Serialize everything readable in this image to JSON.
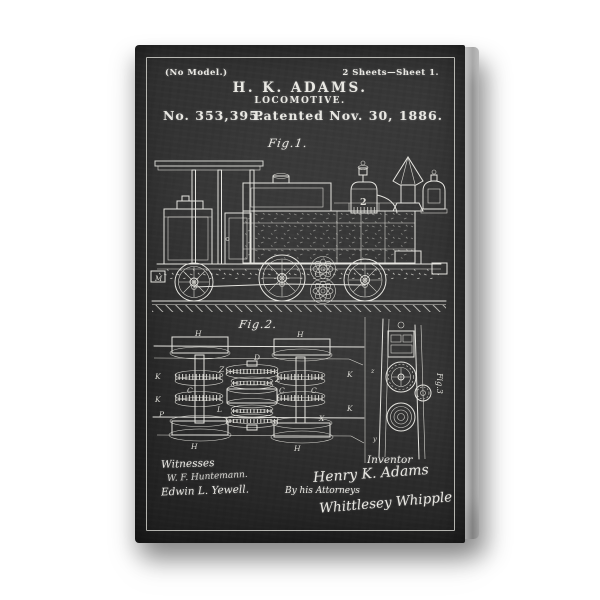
{
  "poster": {
    "background_color": "#ffffff",
    "board_color": "#2d2d2d",
    "chalk_color": "#e9e8e3"
  },
  "header": {
    "no_model": "(No Model.)",
    "sheets_note": "2 Sheets—Sheet 1.",
    "inventor_line": "H. K. ADAMS.",
    "title_line": "LOCOMOTIVE.",
    "patent_number": "No. 353,395.",
    "patent_date": "Patented Nov. 30, 1886."
  },
  "figures": {
    "fig1": {
      "label": "Fig.1.",
      "dome_number": "2",
      "labels": [
        "M"
      ]
    },
    "fig2": {
      "label": "Fig.2.",
      "labels": [
        "H",
        "H",
        "H",
        "H",
        "K",
        "K",
        "K",
        "K",
        "C",
        "C",
        "C",
        "Z",
        "Z",
        "D",
        "P",
        "X",
        "L"
      ]
    },
    "fig3": {
      "label": "Fig.3",
      "labels": [
        "z",
        "y"
      ]
    }
  },
  "signatures": {
    "witnesses_heading": "Witnesses",
    "witness_1": "W. F. Huntemann.",
    "witness_2": "Edwin L. Yewell.",
    "inventor_heading": "Inventor",
    "inventor_signature": "Henry K. Adams",
    "attorney_intro": "By his Attorneys",
    "attorney_signature": "Whittlesey Whipple"
  }
}
